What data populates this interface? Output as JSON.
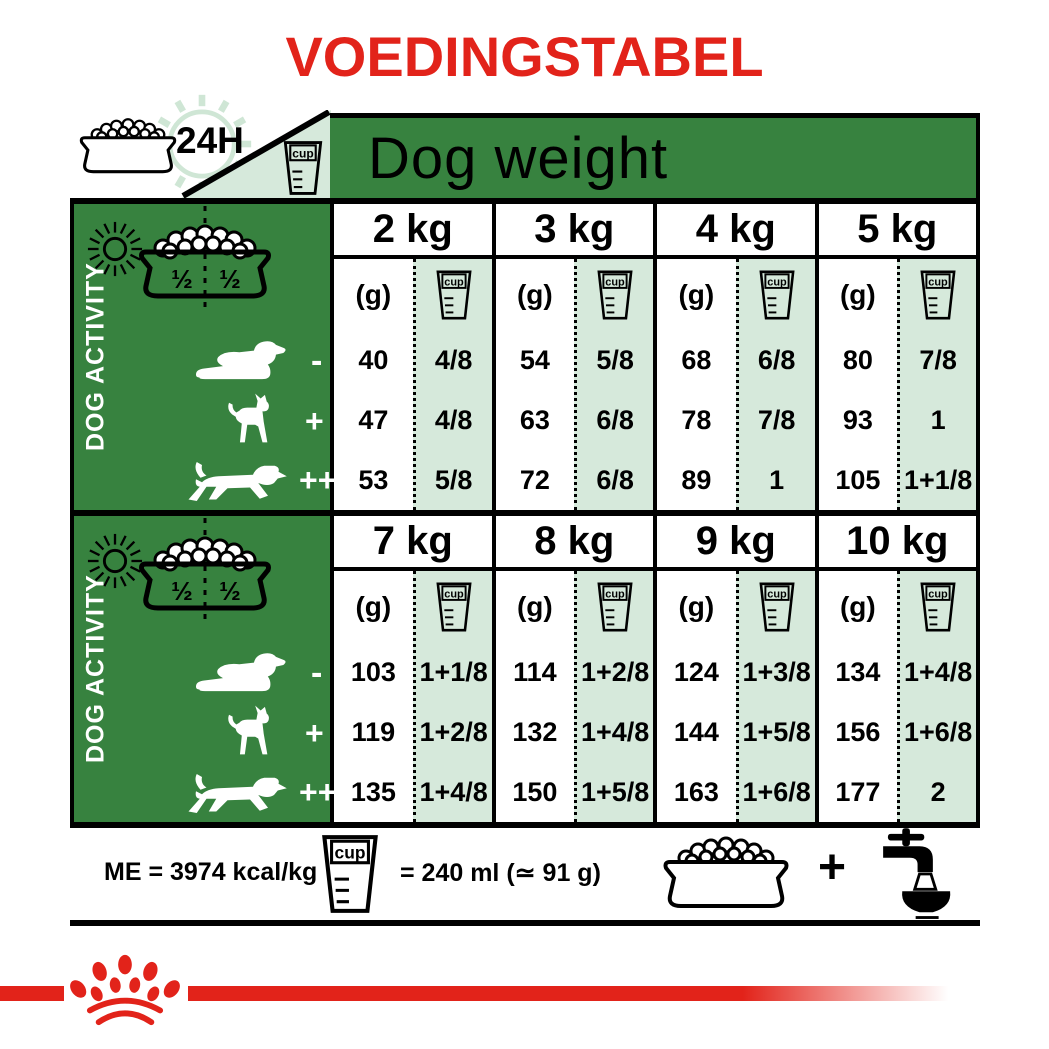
{
  "title": "VOEDINGSTABEL",
  "header": {
    "clock_label": "24H",
    "table_title": "Dog weight"
  },
  "unit": {
    "grams": "(g)",
    "cup": "cup"
  },
  "sidebar": {
    "label": "DOG ACTIVITY",
    "half_left": "½",
    "half_right": "½",
    "activity_symbols": [
      "-",
      "+",
      "++"
    ]
  },
  "sections": [
    {
      "columns": [
        {
          "weight": "2 kg",
          "grams": [
            "40",
            "47",
            "53"
          ],
          "cups": [
            "4/8",
            "4/8",
            "5/8"
          ]
        },
        {
          "weight": "3 kg",
          "grams": [
            "54",
            "63",
            "72"
          ],
          "cups": [
            "5/8",
            "6/8",
            "6/8"
          ]
        },
        {
          "weight": "4 kg",
          "grams": [
            "68",
            "78",
            "89"
          ],
          "cups": [
            "6/8",
            "7/8",
            "1"
          ]
        },
        {
          "weight": "5 kg",
          "grams": [
            "80",
            "93",
            "105"
          ],
          "cups": [
            "7/8",
            "1",
            "1+1/8"
          ]
        }
      ]
    },
    {
      "columns": [
        {
          "weight": "7 kg",
          "grams": [
            "103",
            "119",
            "135"
          ],
          "cups": [
            "1+1/8",
            "1+2/8",
            "1+4/8"
          ]
        },
        {
          "weight": "8 kg",
          "grams": [
            "114",
            "132",
            "150"
          ],
          "cups": [
            "1+2/8",
            "1+4/8",
            "1+5/8"
          ]
        },
        {
          "weight": "9 kg",
          "grams": [
            "124",
            "144",
            "163"
          ],
          "cups": [
            "1+3/8",
            "1+5/8",
            "1+6/8"
          ]
        },
        {
          "weight": "10 kg",
          "grams": [
            "134",
            "156",
            "177"
          ],
          "cups": [
            "1+4/8",
            "1+6/8",
            "2"
          ]
        }
      ]
    }
  ],
  "footer": {
    "me_text": "ME = 3974 kcal/kg",
    "cup_equiv": "= 240 ml (≃ 91 g)",
    "plus": "+"
  },
  "colors": {
    "red": "#e2231a",
    "green": "#37823f",
    "mint": "#d6e9db"
  }
}
